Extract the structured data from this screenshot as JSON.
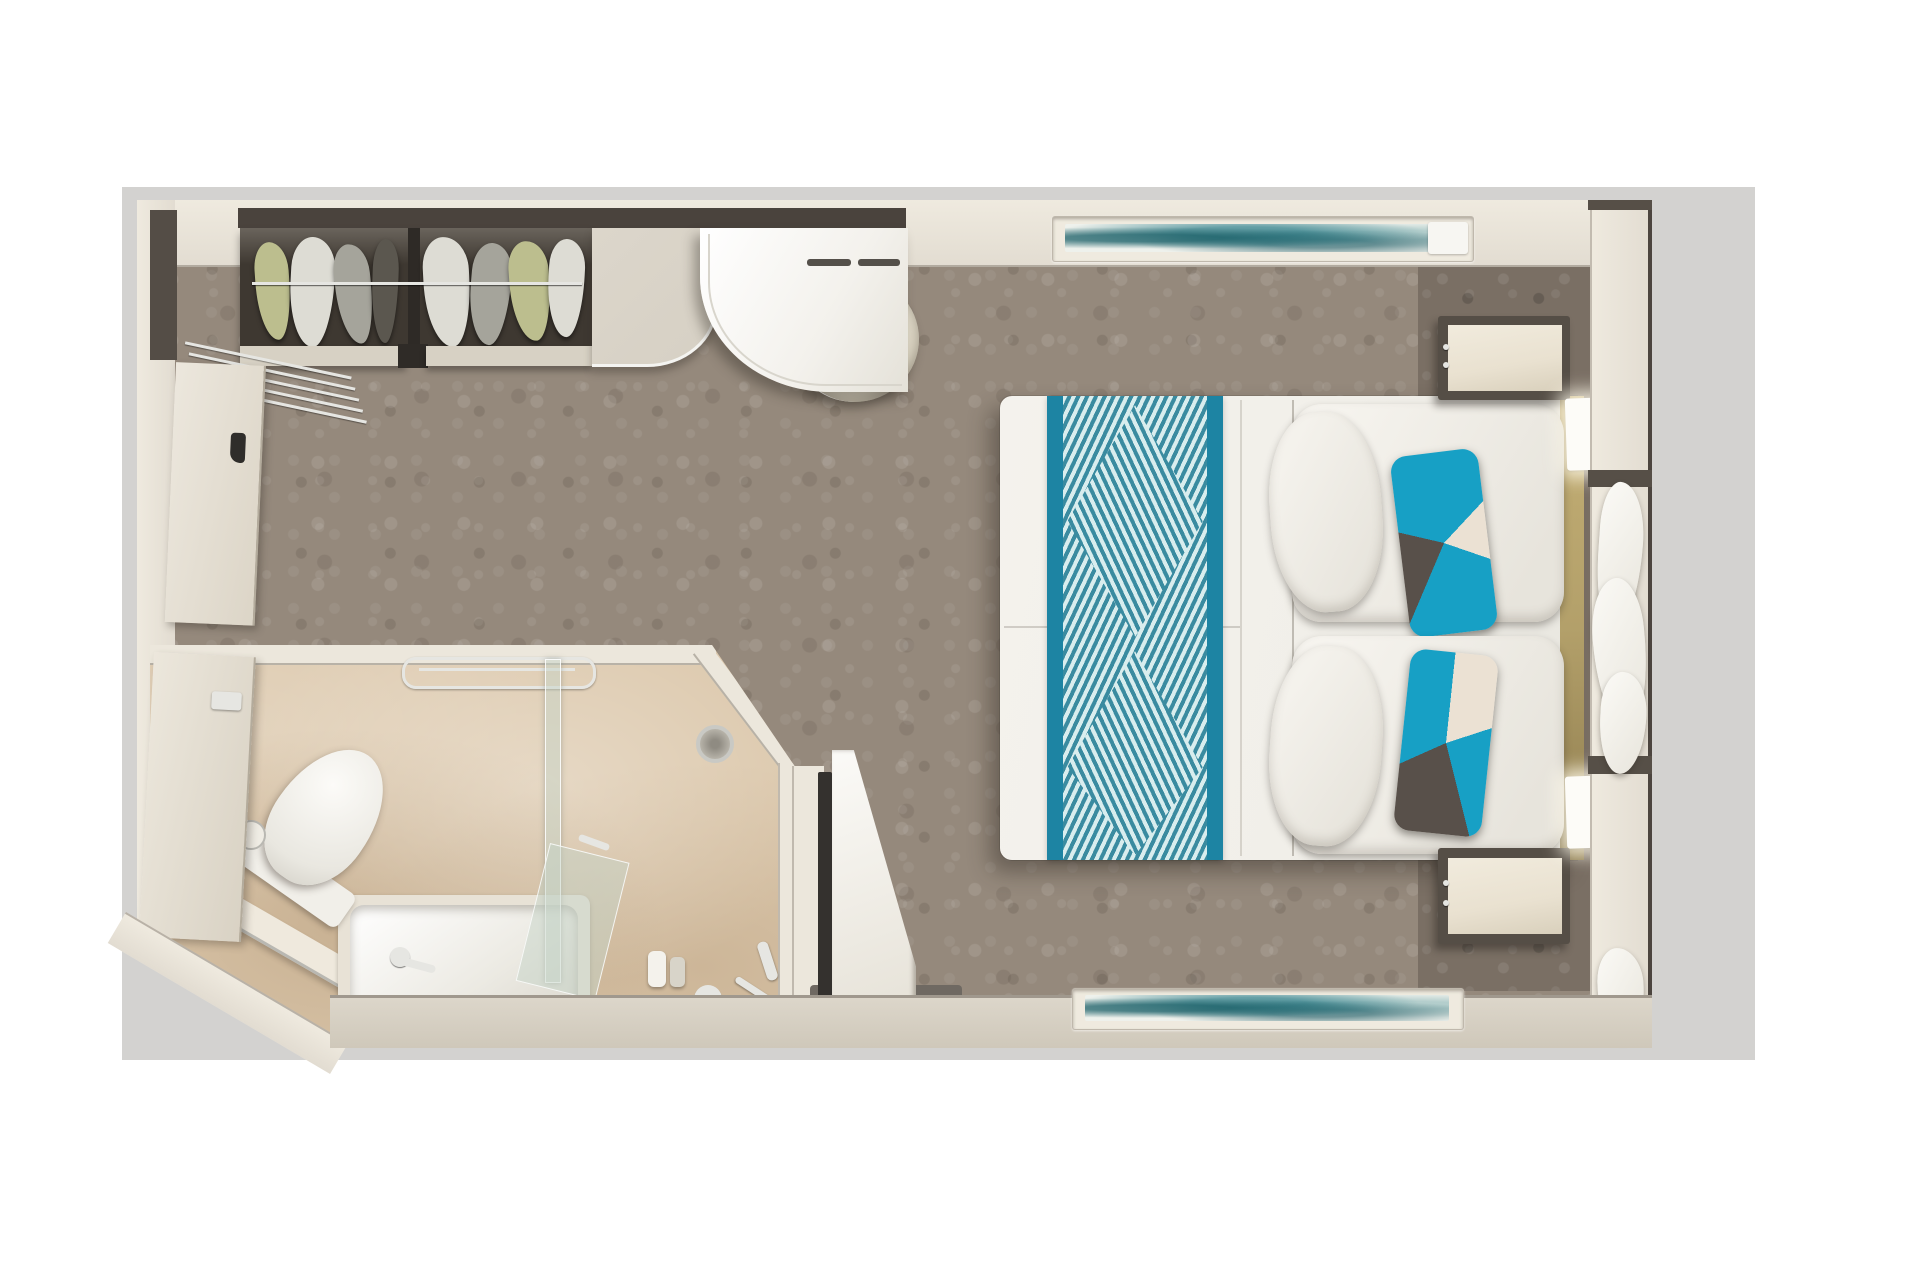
{
  "scene": {
    "type": "floor-plan",
    "description": "Top-down 3D rendered floor plan of a cabin stateroom with bedroom, bathroom, closet and window wall"
  },
  "labels": {
    "plan": "cabin floor plan",
    "bedroom": "bedroom",
    "bathroom": "bathroom",
    "closet": "wardrobe closet with hanging clothes",
    "desk": "curved vanity desk",
    "counter": "cabinet counter",
    "stool": "round stool",
    "bed": "double bed with teal runner",
    "runner": "teal patterned bed runner",
    "pillow": "white pillow",
    "accent_pillow": "teal geometric accent pillow",
    "headboard": "headboard",
    "nightstand": "nightstand",
    "sconce": "wall sconce light",
    "artwork": "abstract teal artwork",
    "window_wall": "window wall with frames",
    "curtains": "curtains",
    "entry_door": "entrance door",
    "bathroom_door": "bathroom door",
    "toilet": "toilet",
    "toilet_paper": "toilet paper holder",
    "bathtub": "bathtub with faucet",
    "shower": "shower area",
    "glass_partition": "glass shower partition",
    "towel_bar": "chrome towel bar",
    "drain": "shower drain",
    "fixtures": "shower fixtures",
    "tv": "wall mounted TV",
    "tv_cabinet": "TV cabinet",
    "luggage_rack": "threshold slats",
    "ledge": "vanity ledge",
    "carpet": "patterned gray carpet",
    "headboard_wall": "textured headboard wall"
  },
  "colors": {
    "page_bg": "#ffffff",
    "mat": "#d3d2d0",
    "wall": "#e2dcd1",
    "wall_light": "#efeadf",
    "wall_dark": "#4c453f",
    "fascia_dark": "#4a433d",
    "carpet": "#95897c",
    "closet_dark": "#3e3831",
    "chrome": "#e6e6e2",
    "chrome_dim": "#b9b8b2",
    "desk": "#f3f1ec",
    "counter": "#d6d0c4",
    "stool": "#ebe6d8",
    "bed": "#f1efe9",
    "runner": "#1d84a3",
    "runner_stripe": "#3a8ba0",
    "runner_stripe_light": "#d8edee",
    "accent_teal": "#17a0c5",
    "accent_dark": "#58504a",
    "accent_cream": "#ebe1d3",
    "gold": "#b3a06a",
    "texwall": "#7a6f64",
    "nightstand": "#e9e1d0",
    "sconce": "#fdfcf8",
    "bath_wall": "#ece7dc",
    "bath_floor": "#dcc8ac",
    "tub": "#f6f4ef",
    "glass": "rgba(198,211,199,0.5)",
    "tv": "#34312e",
    "shadow_strip": "#6f6962",
    "art_teal": "#2f7f8a",
    "art_bg": "#eef1ec",
    "door": "#e7e1d5",
    "g_olive": "#bcbe8e",
    "g_white": "#dddcd4",
    "g_gray": "#a5a49b",
    "g_dark": "#5b574f"
  }
}
